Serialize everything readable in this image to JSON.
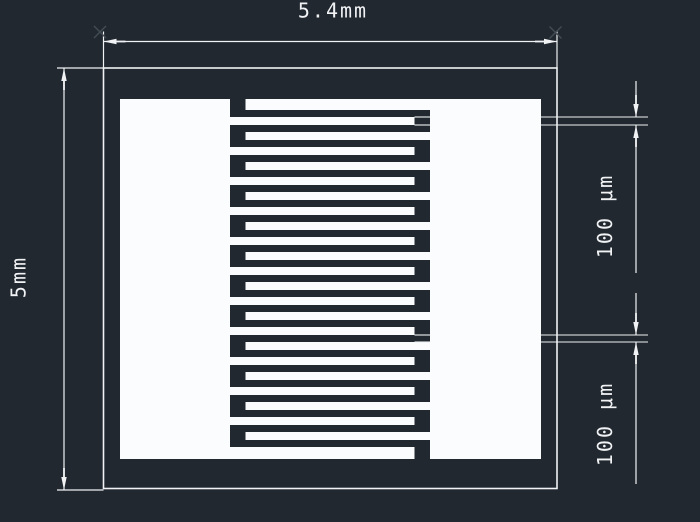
{
  "drawing": {
    "title": "interdigitated-electrode-cad-drawing",
    "colors": {
      "background": "#212830",
      "line": "#f0f2f4",
      "fill": "#fbfcfd",
      "faint_marker": "#434b54"
    },
    "labels": {
      "overall_width": "5.4mm",
      "overall_height": "5mm",
      "finger_width": "100 μm",
      "finger_gap": "100 μm"
    },
    "geometry": {
      "canvas": {
        "w": 700,
        "h": 522
      },
      "outer_rect": {
        "x1": 103.5,
        "y1": 68,
        "x2": 557,
        "y2": 488.5
      },
      "left_pad": {
        "x1": 120,
        "y1": 99,
        "x2": 230,
        "y2": 459
      },
      "right_pad": {
        "x1": 430,
        "y1": 99,
        "x2": 541,
        "y2": 459
      },
      "fingers": {
        "count": 24,
        "first_top": 99,
        "first_thickness": 11,
        "body_first_top": 117,
        "pitch": 15,
        "thickness": 8,
        "left_attach_x": 230,
        "left_tip_x": 414.5,
        "right_tip_x": 245.5,
        "right_attach_x": 430,
        "last_bottom": 459
      },
      "dim_top": {
        "line_y": 41.5,
        "x1": 103.5,
        "x2": 557,
        "ext_top_y": 31.5,
        "text_x": 333,
        "text_y": 17.5
      },
      "dim_left": {
        "line_x": 64,
        "y1": 68,
        "y2": 490,
        "ext_x1": 57,
        "ext_x2": 103.5,
        "text_x": 18.5,
        "text_y": 277
      },
      "dim_right_1": {
        "line_x": 636,
        "measure_top_y": 117,
        "measure_bot_y": 125,
        "seg1_y": 81,
        "seg2_y": 273,
        "ext_gap_x1": 414.5,
        "ext_gap_x2": 430,
        "ext_out_x1": 541,
        "ext_out_x2": 648,
        "text_x": 605,
        "text_y": 216
      },
      "dim_right_2": {
        "line_x": 636,
        "measure_top_y": 335,
        "measure_bot_y": 342,
        "seg1_y": 293,
        "seg2_y": 484,
        "ext_gap_x1": 414.5,
        "ext_gap_x2": 430,
        "ext_out_x1": 541,
        "ext_out_x2": 648,
        "text_x": 605,
        "text_y": 424
      },
      "defpoint_markers": [
        {
          "x": 100,
          "y": 32
        },
        {
          "x": 555.5,
          "y": 32.5
        }
      ]
    }
  }
}
